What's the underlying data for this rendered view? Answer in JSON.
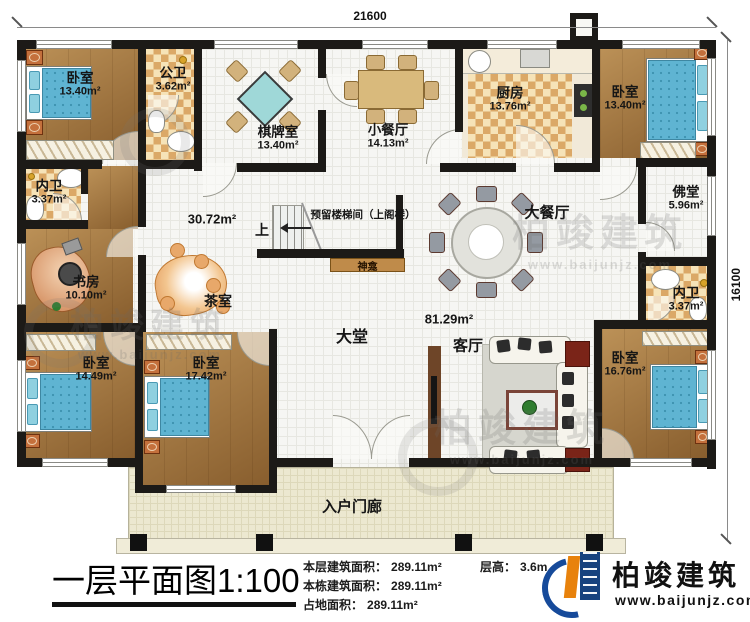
{
  "dims": {
    "top": "21600",
    "right": "16100"
  },
  "rooms": [
    {
      "name": "卧室",
      "area": "13.40m²"
    },
    {
      "name": "公卫",
      "area": "3.62m²"
    },
    {
      "name": "棋牌室",
      "area": "13.40m²"
    },
    {
      "name": "小餐厅",
      "area": "14.13m²"
    },
    {
      "name": "厨房",
      "area": "13.76m²"
    },
    {
      "name": "卧室",
      "area": "13.40m²"
    },
    {
      "name": "内卫",
      "area": "3.37m²"
    },
    {
      "name": "佛堂",
      "area": "5.96m²"
    },
    {
      "name": "书房",
      "area": "10.10m²"
    },
    {
      "name": "茶室",
      "area": ""
    },
    {
      "name": "大餐厅",
      "area": ""
    },
    {
      "name": "神龛",
      "area": ""
    },
    {
      "name": "内卫",
      "area": "3.37m²"
    },
    {
      "name": "卧室",
      "area": "14.49m²"
    },
    {
      "name": "卧室",
      "area": "17.42m²"
    },
    {
      "name": "大堂",
      "area": ""
    },
    {
      "name": "客厅",
      "area": ""
    },
    {
      "name": "卧室",
      "area": "16.76m²"
    },
    {
      "name": "入户门廊",
      "area": ""
    }
  ],
  "areas": {
    "hall": "30.72m²",
    "great": "81.29m²"
  },
  "stairs": {
    "up": "上",
    "note": "预留楼梯间（上阁楼）"
  },
  "watermark": {
    "name": "柏竣建筑",
    "url": "www.baijunjz.com"
  },
  "footer": {
    "title": "一层平面图1:100",
    "stats": [
      {
        "label": "本层建筑面积：",
        "value": "289.11m²"
      },
      {
        "label": "本栋建筑面积：",
        "value": "289.11m²"
      },
      {
        "label": "占地面积：",
        "value": "289.11m²"
      }
    ],
    "floor_height_label": "层高：",
    "floor_height": "3.6m",
    "logo_name": "柏竣建筑",
    "logo_url": "www.baijunjz.com"
  }
}
